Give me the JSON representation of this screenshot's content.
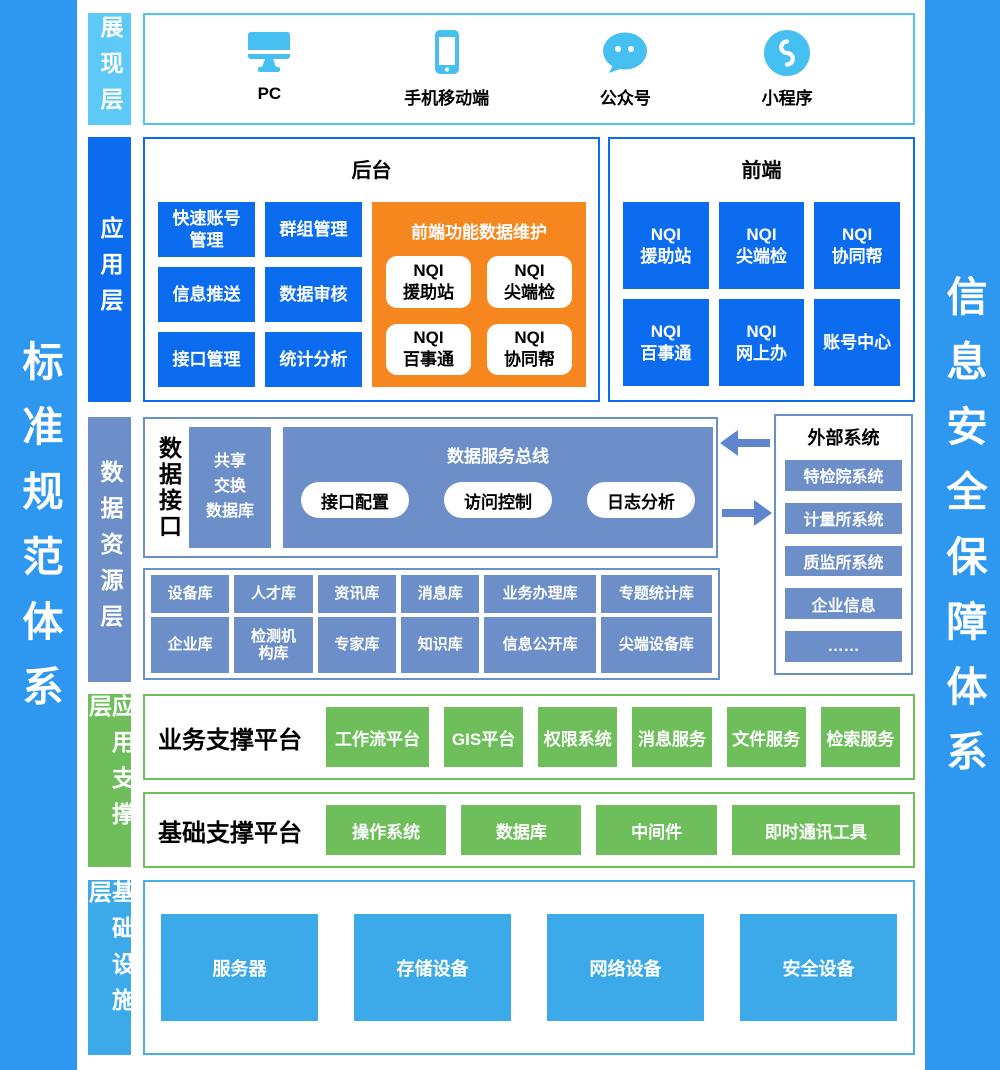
{
  "banners": {
    "left": "标准规范体系",
    "right": "信息安全保障体系"
  },
  "colors": {
    "banner_blue": "#2E97F0",
    "presentation_light_blue": "#5CC9F7",
    "icon_sky_blue": "#45C0F1",
    "application_blue": "#0B6CF0",
    "maintenance_orange": "#F6871F",
    "data_slate_blue": "#6C8EC9",
    "arrow_blue": "#5F86CC",
    "support_green": "#6EBE5C",
    "infrastructure_blue": "#3CAAE8"
  },
  "presentation": {
    "label": "展现层",
    "items": [
      {
        "icon": "desktop-icon",
        "name": "PC"
      },
      {
        "icon": "phone-icon",
        "name": "手机移动端"
      },
      {
        "icon": "official-account-icon",
        "name": "公众号"
      },
      {
        "icon": "mini-program-icon",
        "name": "小程序"
      }
    ]
  },
  "application": {
    "label": "应用层",
    "backend": {
      "title": "后台",
      "buttons": [
        "快速账号\n管理",
        "群组管理",
        "信息推送",
        "数据审核",
        "接口管理",
        "统计分析"
      ],
      "maintenance": {
        "title": "前端功能数据维护",
        "cards": [
          "NQI\n援助站",
          "NQI\n尖端检",
          "NQI\n百事通",
          "NQI\n协同帮"
        ]
      }
    },
    "frontend": {
      "title": "前端",
      "buttons": [
        "NQI\n援助站",
        "NQI\n尖端检",
        "NQI\n协同帮",
        "NQI\n百事通",
        "NQI\n网上办",
        "账号中心"
      ]
    }
  },
  "data_layer": {
    "label": "数据资源层",
    "interface_title": "数据接口",
    "share_db": "共享\n交换\n数据库",
    "bus": {
      "title": "数据服务总线",
      "pills": [
        "接口配置",
        "访问控制",
        "日志分析"
      ]
    },
    "external": {
      "title": "外部系统",
      "items": [
        "特检院系统",
        "计量所系统",
        "质监所系统",
        "企业信息",
        "……"
      ]
    },
    "databases": {
      "row1": [
        "设备库",
        "人才库",
        "资讯库",
        "消息库",
        "业务办理库",
        "专题统计库"
      ],
      "row2": [
        "企业库",
        "检测机\n构库",
        "专家库",
        "知识库",
        "信息公开库",
        "尖端设备库"
      ]
    }
  },
  "support": {
    "label": "应用支撑层",
    "business": {
      "title": "业务支撑平台",
      "buttons": [
        "工作流平台",
        "GIS平台",
        "权限系统",
        "消息服务",
        "文件服务",
        "检索服务"
      ]
    },
    "base": {
      "title": "基础支撑平台",
      "buttons": [
        "操作系统",
        "数据库",
        "中间件",
        "即时通讯工具"
      ]
    }
  },
  "infrastructure": {
    "label": "基础设施层",
    "items": [
      "服务器",
      "存储设备",
      "网络设备",
      "安全设备"
    ]
  }
}
